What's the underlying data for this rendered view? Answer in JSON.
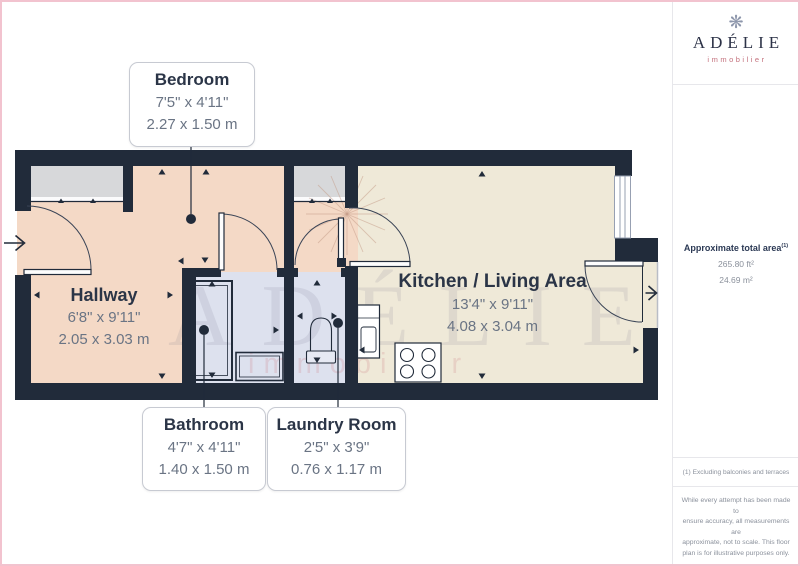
{
  "logo": {
    "icon": "snowflake-icon",
    "icon_glyph": "❋",
    "name": "ADÉLIE",
    "tagline": "immobilier"
  },
  "panel": {
    "area_label": "Approximate total area",
    "area_footnote_ref": "(1)",
    "area_imperial": "265.80 ft²",
    "area_metric": "24.69 m²",
    "footnote": "(1) Excluding balconies and terraces",
    "disclaimer_lines": [
      "While every attempt has been made to",
      "ensure accuracy, all measurements are",
      "approximate, not to scale. This floor",
      "plan is for illustrative purposes only."
    ],
    "brand": "GIRAFFE",
    "brand_suffix": "360"
  },
  "rooms": {
    "bedroom": {
      "name": "Bedroom",
      "imperial": "7'5\" x 4'11\"",
      "metric": "2.27 x 1.50 m"
    },
    "hallway": {
      "name": "Hallway",
      "imperial": "6'8\" x 9'11\"",
      "metric": "2.05 x 3.03 m"
    },
    "bathroom": {
      "name": "Bathroom",
      "imperial": "4'7\" x 4'11\"",
      "metric": "1.40 x 1.50 m"
    },
    "laundry": {
      "name": "Laundry Room",
      "imperial": "2'5\" x 3'9\"",
      "metric": "0.76 x 1.17 m"
    },
    "kitchen": {
      "name": "Kitchen / Living Area",
      "imperial": "13'4\" x 9'11\"",
      "metric": "4.08 x 3.04 m"
    }
  },
  "watermark": {
    "text": "ADÉLIE",
    "subtext": "immobilier"
  },
  "colors": {
    "wall": "#212b3a",
    "floor_warm": "#f4d9c6",
    "floor_cool": "#dde1ee",
    "floor_cream": "#efe9d8",
    "closet_gray": "#d7d8da",
    "accent_pink": "#c4717d",
    "navy": "#2c3a55",
    "frame_pink": "#f2c3cf"
  }
}
